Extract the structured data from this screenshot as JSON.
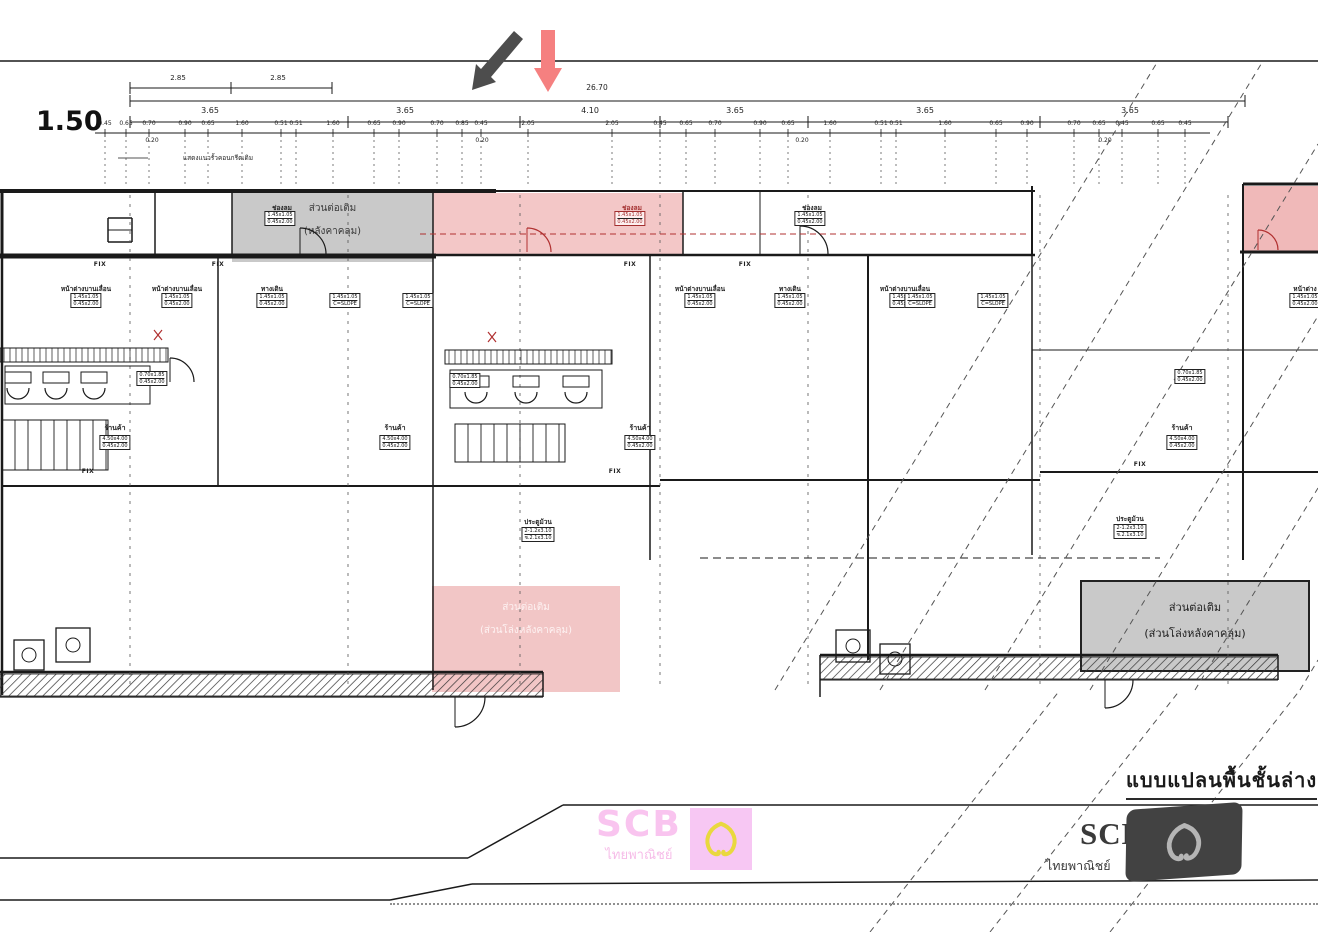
{
  "scale_label": "1.50",
  "title_block": {
    "drawing_title": "แบบแปลนพื้นชั้นล่าง"
  },
  "notes": [
    {
      "t": "แสดงแนวรั้วคอนกรีตเดิม",
      "x": 218,
      "y": 153
    }
  ],
  "dimensions": {
    "top_pair": [
      {
        "v": "2.85",
        "x": 178
      },
      {
        "v": "2.85",
        "x": 278
      }
    ],
    "overall": {
      "v": "26.70",
      "x": 597
    },
    "bays": [
      {
        "v": "3.65",
        "x": 210
      },
      {
        "v": "3.65",
        "x": 405
      },
      {
        "v": "4.10",
        "x": 590
      },
      {
        "v": "3.65",
        "x": 735
      },
      {
        "v": "3.65",
        "x": 925
      },
      {
        "v": "3.65",
        "x": 1130
      }
    ],
    "details": [
      [
        105,
        "0.45"
      ],
      [
        126,
        "0.65"
      ],
      [
        149,
        "0.70"
      ],
      [
        185,
        "0.90"
      ],
      [
        208,
        "0.65"
      ],
      [
        242,
        "1.60"
      ],
      [
        281,
        "0.51"
      ],
      [
        296,
        "0.51"
      ],
      [
        333,
        "1.60"
      ],
      [
        374,
        "0.65"
      ],
      [
        399,
        "0.90"
      ],
      [
        437,
        "0.70"
      ],
      [
        462,
        "0.85"
      ],
      [
        481,
        "0.45"
      ],
      [
        528,
        "2.05"
      ],
      [
        612,
        "2.05"
      ],
      [
        660,
        "0.45"
      ],
      [
        686,
        "0.65"
      ],
      [
        715,
        "0.70"
      ],
      [
        760,
        "0.90"
      ],
      [
        788,
        "0.65"
      ],
      [
        830,
        "1.60"
      ],
      [
        881,
        "0.51"
      ],
      [
        896,
        "0.51"
      ],
      [
        945,
        "1.60"
      ],
      [
        996,
        "0.65"
      ],
      [
        1027,
        "0.90"
      ],
      [
        1074,
        "0.70"
      ],
      [
        1099,
        "0.65"
      ],
      [
        1122,
        "0.45"
      ],
      [
        1158,
        "0.65"
      ],
      [
        1185,
        "0.45"
      ]
    ],
    "sub_marks": [
      {
        "v": "0.20",
        "x": 152
      },
      {
        "v": "0.20",
        "x": 482
      },
      {
        "v": "0.20",
        "x": 802
      },
      {
        "v": "0.20",
        "x": 1105
      }
    ]
  },
  "zones": {
    "extension_top": {
      "line1": "ส่วนต่อเติม",
      "line2": "(หลังคาคลุม)"
    },
    "extension_bottom_center": {
      "line1": "ส่วนต่อเติม",
      "line2": "(ส่วนโล่งหลังคาคลุม)"
    },
    "extension_bottom_right": {
      "line1": "ส่วนต่อเติม",
      "line2": "(ส่วนโล่งหลังคาคลุม)"
    }
  },
  "labels": [
    {
      "t": "ช่องลม",
      "x": 282,
      "y": 203
    },
    {
      "t": "ช่องลม",
      "x": 632,
      "y": 203,
      "red": true
    },
    {
      "t": "ช่องลม",
      "x": 812,
      "y": 203
    },
    {
      "t": "FIX",
      "x": 100,
      "y": 261,
      "cls": "fix"
    },
    {
      "t": "FIX",
      "x": 218,
      "y": 261,
      "cls": "fix"
    },
    {
      "t": "FIX",
      "x": 630,
      "y": 261,
      "cls": "fix"
    },
    {
      "t": "FIX",
      "x": 745,
      "y": 261,
      "cls": "fix"
    },
    {
      "t": "หน้าต่างบานเลื่อน",
      "x": 86,
      "y": 284
    },
    {
      "t": "หน้าต่างบานเลื่อน",
      "x": 177,
      "y": 284
    },
    {
      "t": "ทางเดิน",
      "x": 272,
      "y": 284
    },
    {
      "t": "หน้าต่างบานเลื่อน",
      "x": 700,
      "y": 284
    },
    {
      "t": "ทางเดิน",
      "x": 790,
      "y": 284
    },
    {
      "t": "หน้าต่างบานเลื่อน",
      "x": 905,
      "y": 284
    },
    {
      "t": "หน้าต่าง",
      "x": 1305,
      "y": 284
    },
    {
      "t": "ร้านค้า",
      "x": 115,
      "y": 423,
      "cls": "shop"
    },
    {
      "t": "ร้านค้า",
      "x": 395,
      "y": 423,
      "cls": "shop"
    },
    {
      "t": "ร้านค้า",
      "x": 640,
      "y": 423,
      "cls": "shop"
    },
    {
      "t": "ร้านค้า",
      "x": 1182,
      "y": 423,
      "cls": "shop"
    },
    {
      "t": "FIX",
      "x": 88,
      "y": 468,
      "cls": "fix"
    },
    {
      "t": "FIX",
      "x": 615,
      "y": 468,
      "cls": "fix"
    },
    {
      "t": "FIX",
      "x": 1140,
      "y": 461,
      "cls": "fix"
    },
    {
      "t": "ประตูม้วน",
      "x": 538,
      "y": 517
    },
    {
      "t": "ประตูม้วน",
      "x": 1130,
      "y": 514
    }
  ],
  "tags": [
    {
      "x": 280,
      "y": 211,
      "lines": [
        "1.45x1.05",
        "0.45x2.00"
      ]
    },
    {
      "x": 630,
      "y": 211,
      "lines": [
        "1.45x1.05",
        "0.45x2.00"
      ],
      "red": true
    },
    {
      "x": 810,
      "y": 211,
      "lines": [
        "1.45x1.05",
        "0.45x2.00"
      ]
    },
    {
      "x": 86,
      "y": 293,
      "lines": [
        "1.45x1.05",
        "0.45x2.00"
      ]
    },
    {
      "x": 177,
      "y": 293,
      "lines": [
        "1.45x1.05",
        "0.45x2.00"
      ]
    },
    {
      "x": 272,
      "y": 293,
      "lines": [
        "1.45x1.05",
        "0.45x2.00"
      ]
    },
    {
      "x": 700,
      "y": 293,
      "lines": [
        "1.45x1.05",
        "0.45x2.00"
      ]
    },
    {
      "x": 790,
      "y": 293,
      "lines": [
        "1.45x1.05",
        "0.45x2.00"
      ]
    },
    {
      "x": 905,
      "y": 293,
      "lines": [
        "1.45x1.05",
        "0.45x2.00"
      ]
    },
    {
      "x": 1305,
      "y": 293,
      "lines": [
        "1.45x1.05",
        "0.45x2.00"
      ]
    },
    {
      "x": 345,
      "y": 293,
      "lines": [
        "1.45x1.05",
        "C=SLOPE"
      ]
    },
    {
      "x": 418,
      "y": 293,
      "lines": [
        "1.45x1.05",
        "C=SLOPE"
      ]
    },
    {
      "x": 920,
      "y": 293,
      "lines": [
        "1.45x1.05",
        "C=SLOPE"
      ]
    },
    {
      "x": 993,
      "y": 293,
      "lines": [
        "1.45x1.05",
        "C=SLOPE"
      ]
    },
    {
      "x": 152,
      "y": 371,
      "lines": [
        "0.70x1.85",
        "0.45x2.00"
      ]
    },
    {
      "x": 465,
      "y": 373,
      "lines": [
        "0.70x1.85",
        "0.45x2.00"
      ]
    },
    {
      "x": 1190,
      "y": 369,
      "lines": [
        "0.70x1.85",
        "0.45x2.00"
      ]
    },
    {
      "x": 115,
      "y": 435,
      "lines": [
        "4.50x4.00",
        "0.45x2.00"
      ]
    },
    {
      "x": 395,
      "y": 435,
      "lines": [
        "4.50x4.00",
        "0.45x2.00"
      ]
    },
    {
      "x": 640,
      "y": 435,
      "lines": [
        "4.50x4.00",
        "0.45x2.00"
      ]
    },
    {
      "x": 1182,
      "y": 435,
      "lines": [
        "4.50x4.00",
        "0.45x2.00"
      ]
    },
    {
      "x": 538,
      "y": 527,
      "lines": [
        "2-1.2x3.10",
        "ช.2.1x3.10"
      ]
    },
    {
      "x": 1130,
      "y": 524,
      "lines": [
        "2-1.2x3.10",
        "ช.2.1x3.10"
      ]
    }
  ],
  "logos": {
    "pink": {
      "brand": "SCB",
      "subtext": "ไทยพาณิชย์",
      "box_color": "#f7c7f3",
      "shield_color": "#e9d83e",
      "text_color": "#f9c4ef"
    },
    "dark": {
      "brand": "SCB",
      "subtext": "ไทยพาณิชย์",
      "bg_color": "#424242",
      "shield_color": "#b5b5b5",
      "text_color": "#3a3a3a"
    }
  },
  "colors": {
    "line": "#1a1a1a",
    "red_line": "#b03030",
    "highlight_red": "#f3c7c7",
    "highlight_red_strong": "#f0b9b9",
    "highlight_gray": "#c9c9c9",
    "arrow_dark": "#4d4d4d",
    "arrow_red": "#f58080"
  }
}
